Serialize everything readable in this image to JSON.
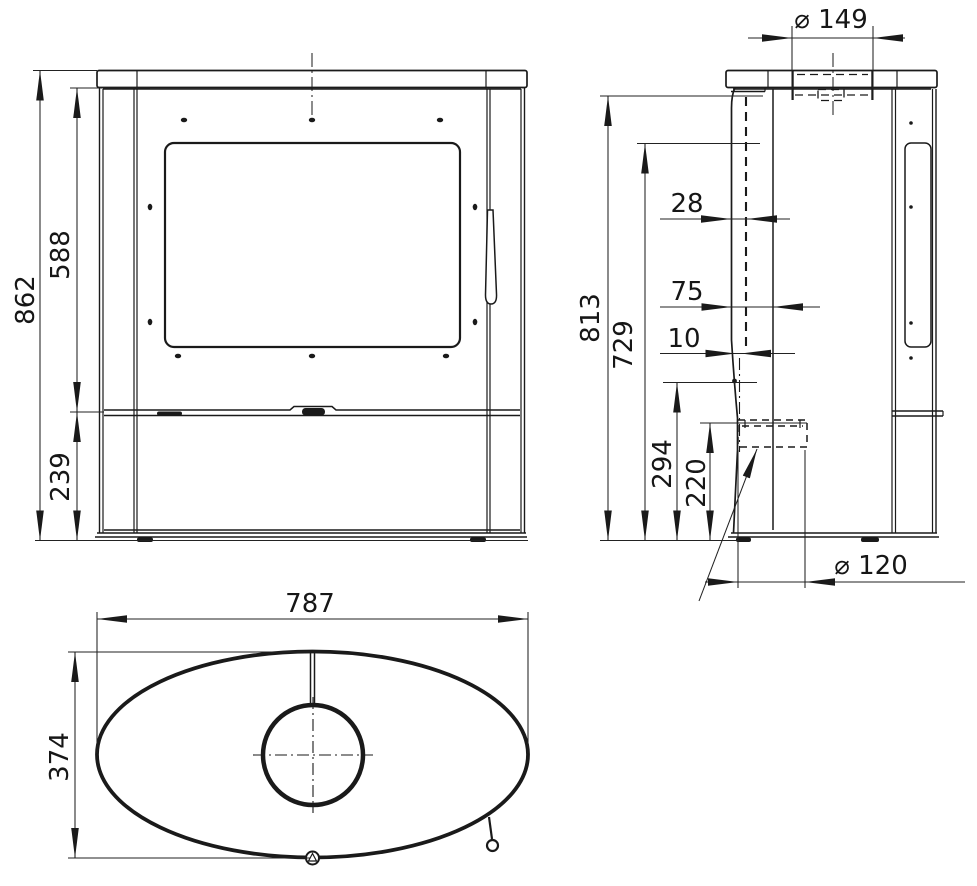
{
  "drawing": {
    "dimensions": {
      "front": {
        "height_total": "862",
        "height_upper": "588",
        "height_lower": "239"
      },
      "side": {
        "diameter_flue_collar": "⌀ 149",
        "height_total": "813",
        "height_inner": "729",
        "offset_a": "28",
        "offset_b": "75",
        "offset_c": "10",
        "height_a": "294",
        "height_b": "220",
        "diameter_air_inlet": "⌀ 120"
      },
      "top": {
        "width": "787",
        "depth": "374"
      }
    }
  }
}
